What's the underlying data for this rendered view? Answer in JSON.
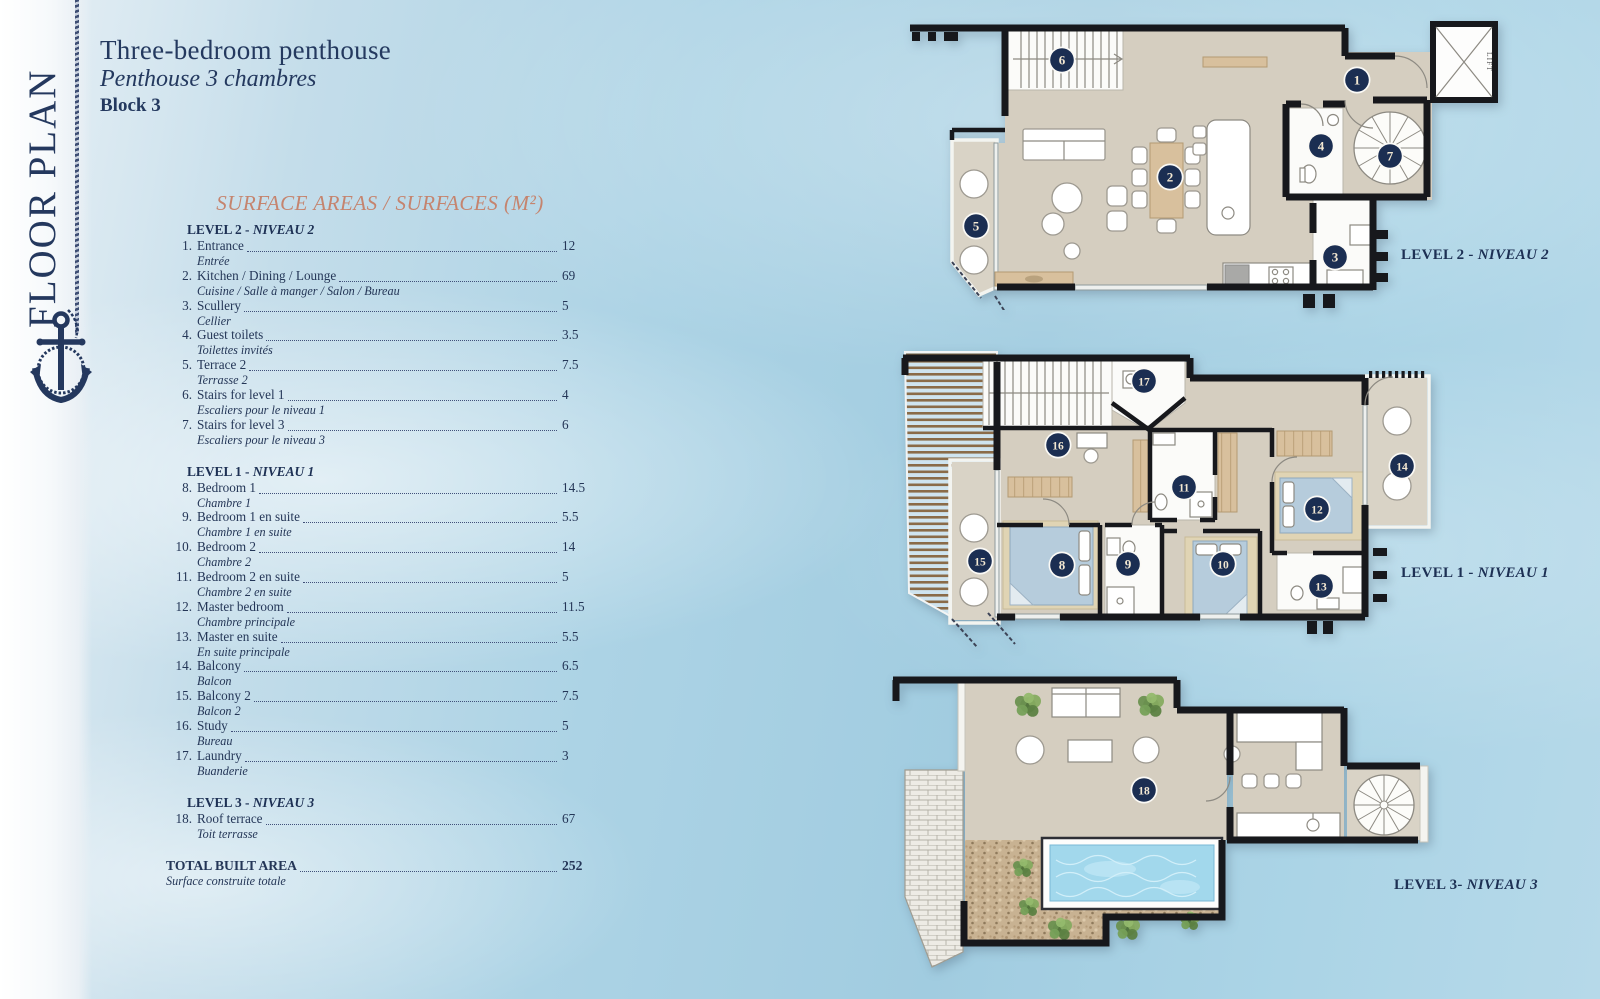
{
  "sidebar": {
    "vertical_title": "FLOOR PLAN"
  },
  "header": {
    "title": "Three-bedroom penthouse",
    "subtitle_fr": "Penthouse 3 chambres",
    "block": "Block 3"
  },
  "surface_table": {
    "heading": "SURFACE AREAS / SURFACES (M²)",
    "sections": [
      {
        "title_bold": "LEVEL 2 -",
        "title_italic": "NIVEAU 2",
        "items": [
          {
            "num": "1.",
            "en": "Entrance",
            "fr": "Entrée",
            "area": "12"
          },
          {
            "num": "2.",
            "en": "Kitchen / Dining / Lounge",
            "fr": "Cuisine / Salle à manger / Salon / Bureau",
            "area": "69"
          },
          {
            "num": "3.",
            "en": "Scullery",
            "fr": "Cellier",
            "area": "5"
          },
          {
            "num": "4.",
            "en": "Guest toilets",
            "fr": "Toilettes invités",
            "area": "3.5"
          },
          {
            "num": "5.",
            "en": "Terrace 2",
            "fr": "Terrasse 2",
            "area": "7.5"
          },
          {
            "num": "6.",
            "en": "Stairs for level 1",
            "fr": "Escaliers pour le niveau 1",
            "area": "4"
          },
          {
            "num": "7.",
            "en": "Stairs for level 3",
            "fr": "Escaliers pour le niveau 3",
            "area": "6"
          }
        ]
      },
      {
        "title_bold": "LEVEL 1 -",
        "title_italic": "NIVEAU 1",
        "items": [
          {
            "num": "8.",
            "en": "Bedroom 1",
            "fr": "Chambre 1",
            "area": "14.5"
          },
          {
            "num": "9.",
            "en": "Bedroom 1 en suite",
            "fr": "Chambre 1 en suite",
            "area": "5.5"
          },
          {
            "num": "10.",
            "en": "Bedroom 2",
            "fr": "Chambre 2",
            "area": "14"
          },
          {
            "num": "11.",
            "en": "Bedroom 2 en suite",
            "fr": "Chambre 2 en suite",
            "area": "5"
          },
          {
            "num": "12.",
            "en": "Master bedroom",
            "fr": "Chambre principale",
            "area": "11.5"
          },
          {
            "num": "13.",
            "en": "Master en suite",
            "fr": "En suite principale",
            "area": "5.5"
          },
          {
            "num": "14.",
            "en": "Balcony",
            "fr": "Balcon",
            "area": "6.5"
          },
          {
            "num": "15.",
            "en": "Balcony 2",
            "fr": "Balcon 2",
            "area": "7.5"
          },
          {
            "num": "16.",
            "en": "Study",
            "fr": "Bureau",
            "area": "5"
          },
          {
            "num": "17.",
            "en": "Laundry",
            "fr": "Buanderie",
            "area": "3"
          }
        ]
      },
      {
        "title_bold": "LEVEL 3 -",
        "title_italic": "NIVEAU 3",
        "items": [
          {
            "num": "18.",
            "en": "Roof terrace",
            "fr": "Toit terrasse",
            "area": "67"
          }
        ]
      }
    ],
    "total": {
      "en": "TOTAL BUILT AREA",
      "fr": "Surface construite totale",
      "area": "252"
    }
  },
  "plans": [
    {
      "id": "level2",
      "label_bold": "LEVEL 2 -",
      "label_italic": "NIVEAU 2",
      "lift_label": "LIFT",
      "markers": [
        "1",
        "2",
        "3",
        "4",
        "5",
        "6",
        "7"
      ]
    },
    {
      "id": "level1",
      "label_bold": "LEVEL 1 -",
      "label_italic": "NIVEAU 1",
      "markers": [
        "8",
        "9",
        "10",
        "11",
        "12",
        "13",
        "14",
        "15",
        "16",
        "17"
      ]
    },
    {
      "id": "level3",
      "label_bold": "LEVEL 3-",
      "label_italic": "NIVEAU 3",
      "markers": [
        "18"
      ]
    }
  ],
  "colors": {
    "navy_text": "#24395f",
    "salmon_heading": "#c5846e",
    "marker_disc": "#1b2e52",
    "marker_number": "#f3e8d2",
    "floor_beige": "#d5cec0",
    "pool_water": "#a2d8ec",
    "sky": "#acd3e5"
  }
}
